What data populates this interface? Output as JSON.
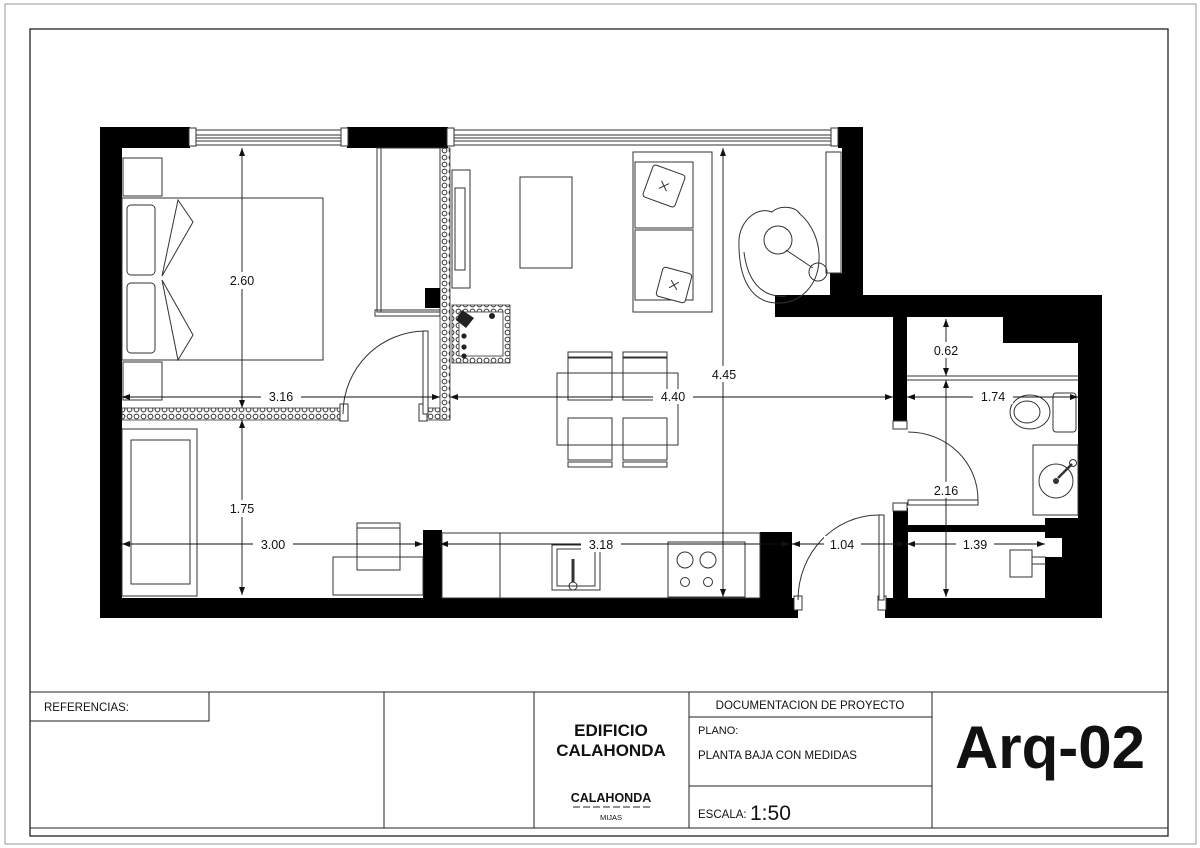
{
  "title_block": {
    "references_label": "REFERENCIAS:",
    "building_line1": "EDIFICIO",
    "building_line2": "CALAHONDA",
    "location_name": "CALAHONDA",
    "location_municipality": "MIJAS",
    "doc_header": "DOCUMENTACION DE PROYECTO",
    "plano_label": "PLANO:",
    "plano_value": "PLANTA BAJA CON MEDIDAS",
    "escala_label": "ESCALA:",
    "escala_value": "1:50",
    "sheet_code": "Arq-02"
  },
  "plan": {
    "dimensions": [
      {
        "name": "bedroom-depth",
        "value": "2.60"
      },
      {
        "name": "bedroom-width",
        "value": "3.16"
      },
      {
        "name": "living-width",
        "value": "4.40"
      },
      {
        "name": "living-depth",
        "value": "4.45"
      },
      {
        "name": "bathroom-width",
        "value": "1.74"
      },
      {
        "name": "shower-depth",
        "value": "0.62"
      },
      {
        "name": "bathroom-depth",
        "value": "2.16"
      },
      {
        "name": "room2-depth",
        "value": "1.75"
      },
      {
        "name": "room2-width",
        "value": "3.00"
      },
      {
        "name": "kitchen-width",
        "value": "3.18"
      },
      {
        "name": "hall-width",
        "value": "1.04"
      },
      {
        "name": "laundry-width",
        "value": "1.39"
      }
    ]
  }
}
